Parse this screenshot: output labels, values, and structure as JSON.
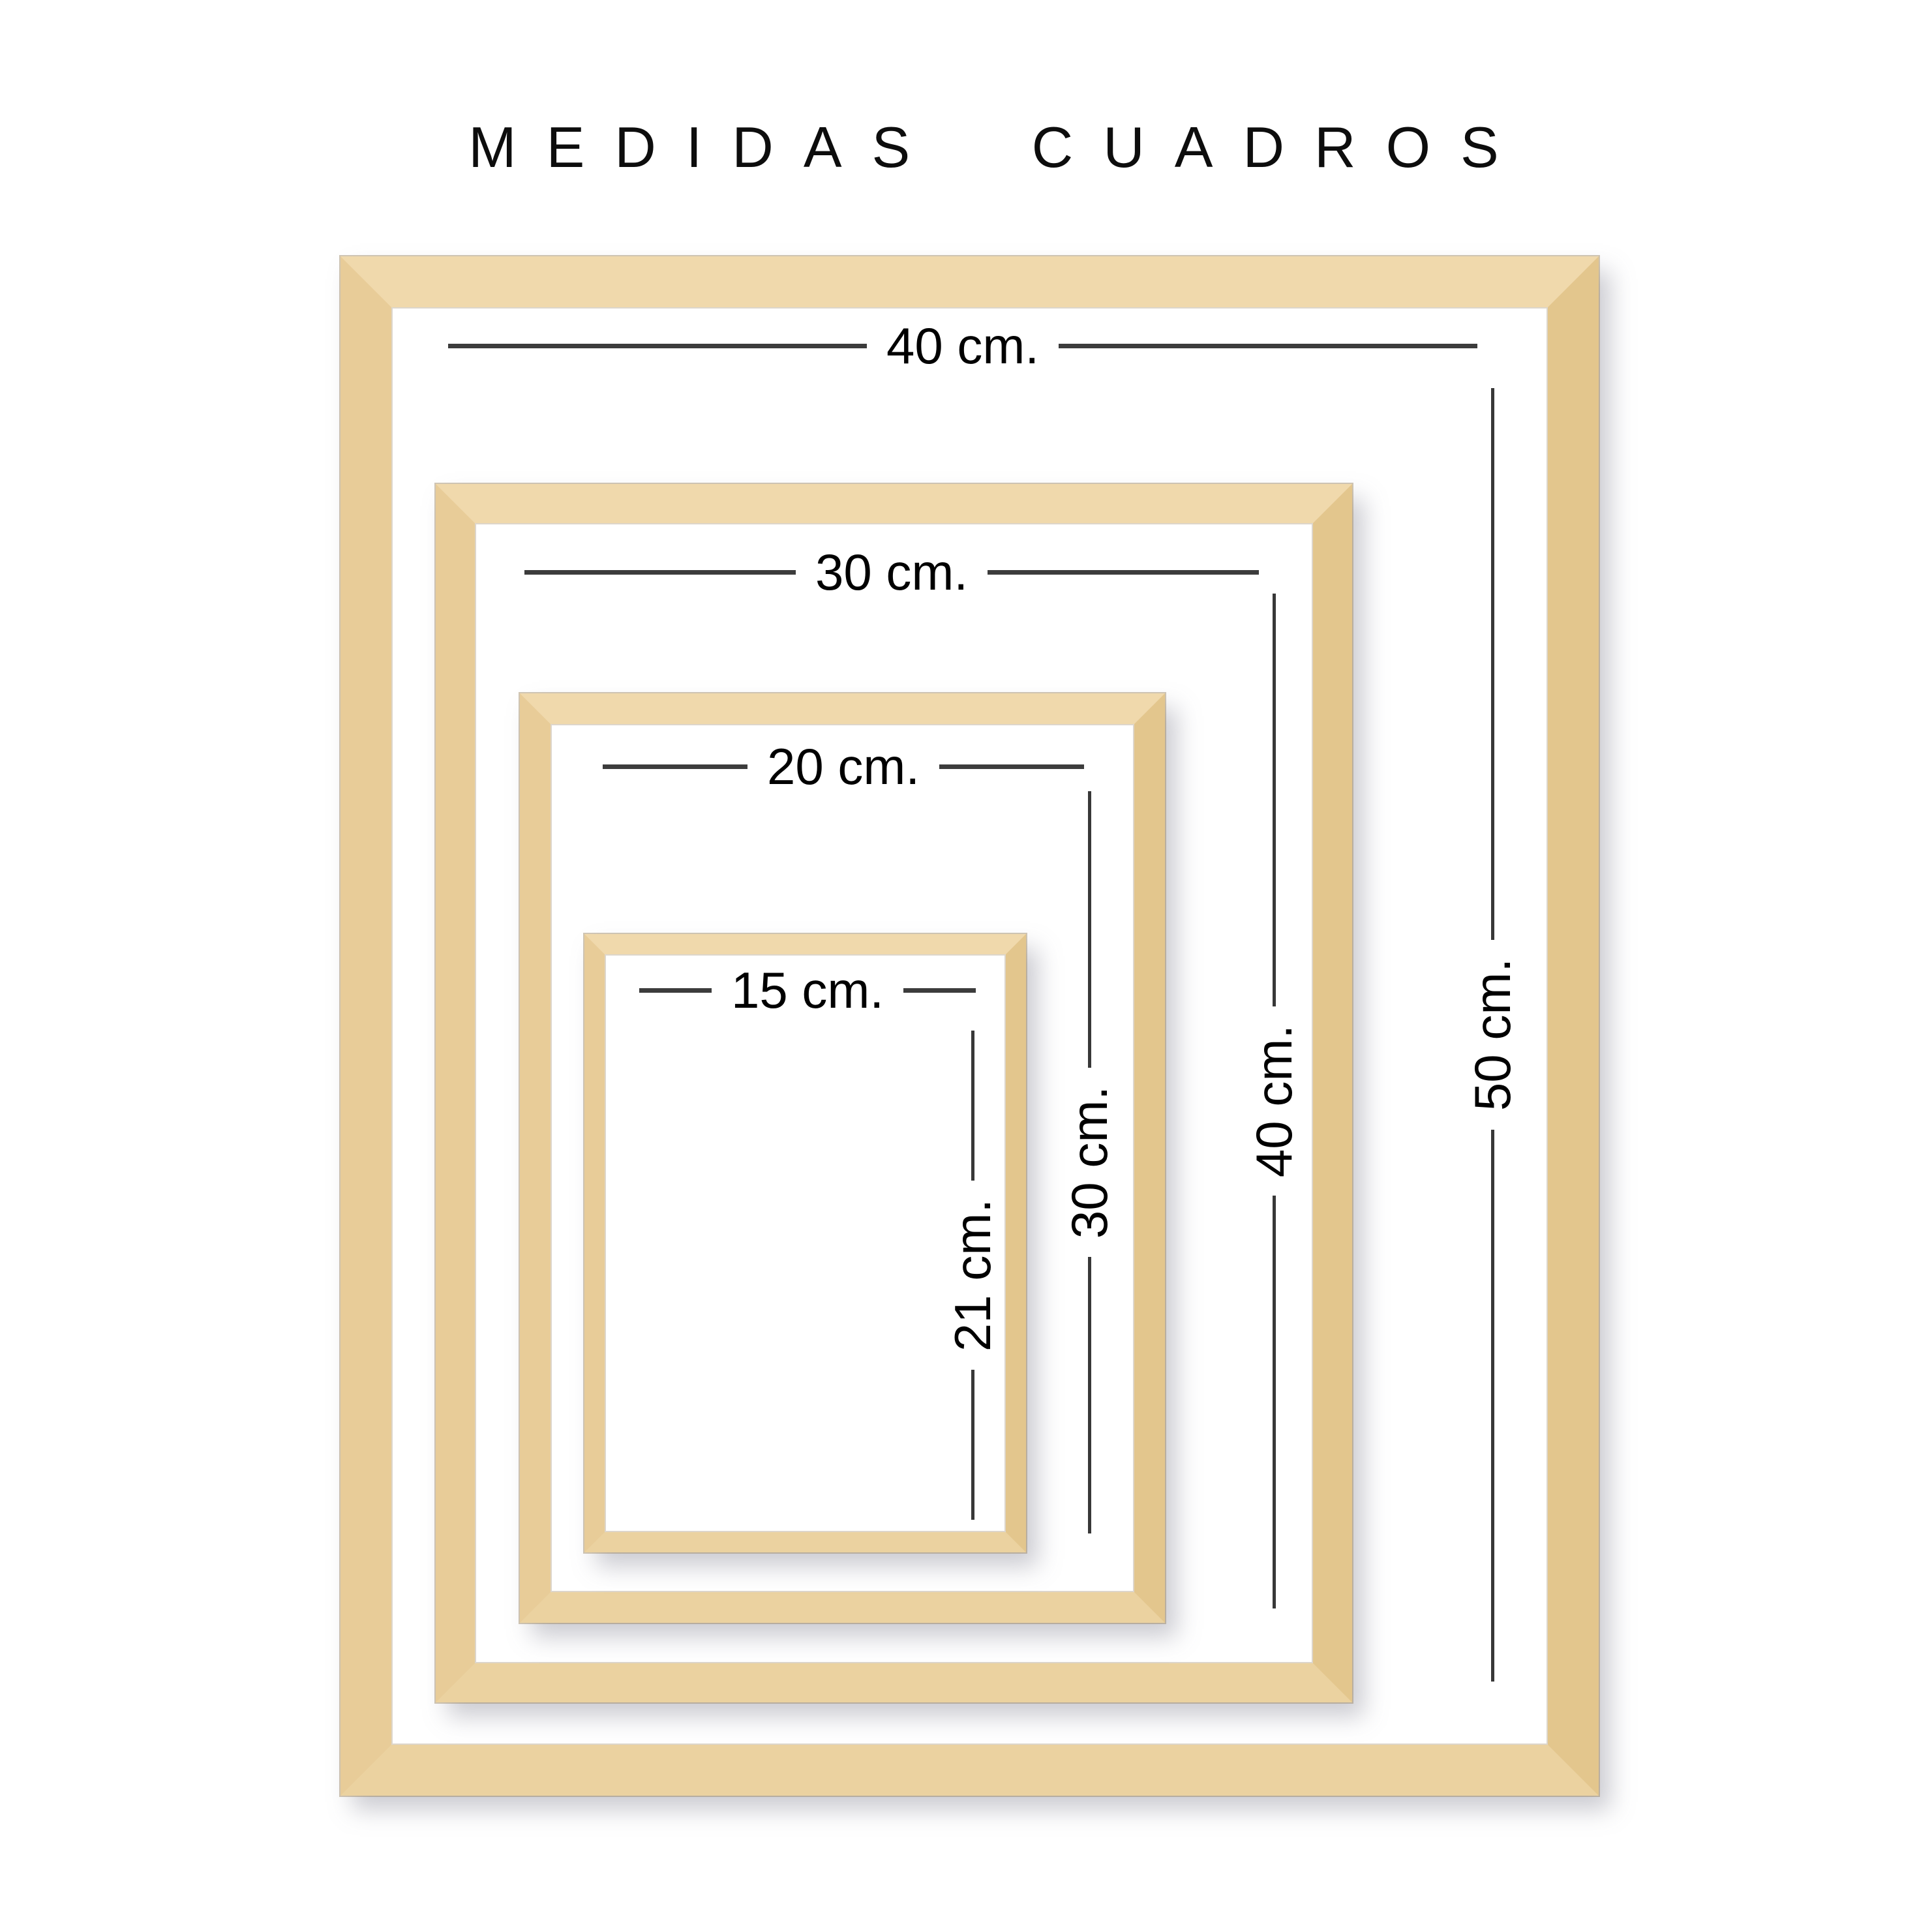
{
  "title": "MEDIDAS CUADROS",
  "frames": [
    {
      "size": "40x50",
      "width_label": "40 cm.",
      "height_label": "50 cm."
    },
    {
      "size": "30x40",
      "width_label": "30 cm.",
      "height_label": "40 cm."
    },
    {
      "size": "20x30",
      "width_label": "20 cm.",
      "height_label": "30 cm."
    },
    {
      "size": "15x21",
      "width_label": "15 cm.",
      "height_label": "21 cm."
    }
  ],
  "colors": {
    "wood": "#ead0a0",
    "wood_highlight": "#f0d9ac",
    "wood_shadow": "#e3c68d",
    "dimension_line": "#3c3c3c",
    "text": "#000000",
    "background": "#ffffff"
  }
}
